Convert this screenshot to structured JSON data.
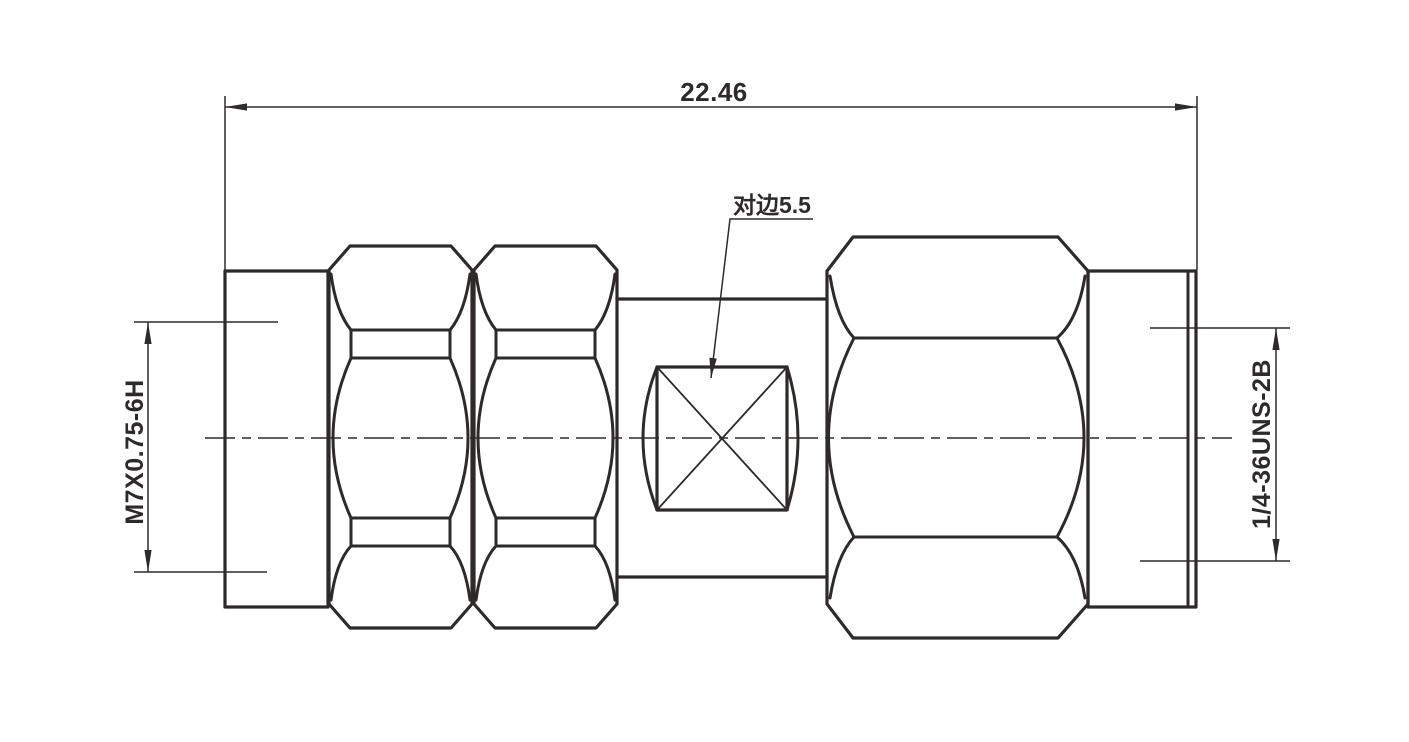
{
  "drawing": {
    "line_color": "#2e2a29",
    "background_color": "#ffffff",
    "dimensions": {
      "overall_length": {
        "label": "22.46"
      },
      "left_thread": {
        "label": "M7X0.75-6H"
      },
      "right_thread": {
        "label": "1/4-36UNS-2B"
      },
      "across_flats": {
        "label": "对边5.5"
      }
    }
  }
}
